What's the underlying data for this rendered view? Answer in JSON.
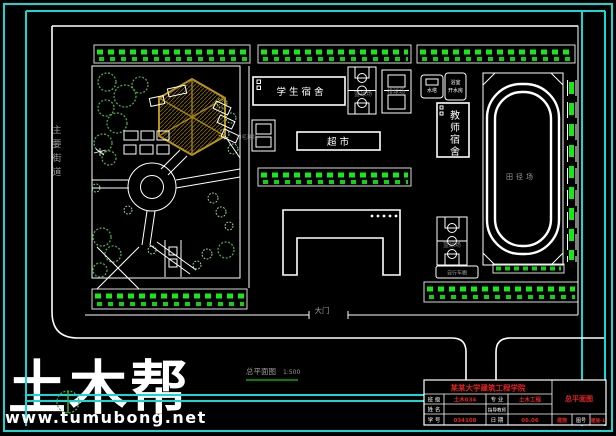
{
  "colors": {
    "background": "#000000",
    "frame_cyan": "#12d8d8",
    "drawing_white": "#ffffff",
    "hedge_green": "#17e817",
    "tree_green": "#4aa84a",
    "pavilion_olive": "#b8921a",
    "label_gray": "#9b9b9b",
    "title_block_red": "#e32222",
    "watermark_brand": "#4c3f24",
    "watermark_url": "#a9a9a9",
    "caption_underline": "#00aa00"
  },
  "watermark": {
    "brand": "土木帮",
    "url": "www.tumubong.net"
  },
  "street": {
    "main_street_chars": [
      "主",
      "要",
      "街",
      "道"
    ],
    "gate_label": "大门"
  },
  "caption": {
    "title": "总平面图",
    "scale": "1:500"
  },
  "buildings": {
    "student_dorm": "学 生 宿 舍",
    "supermarket": "超 市",
    "teacher_dorm_chars": [
      "教",
      "师",
      "宿",
      "舍"
    ],
    "water_tower": "水塔",
    "bathhouse": "浴室",
    "boiler_room": "开水房",
    "bike_shed": "自行车棚"
  },
  "sports": {
    "basketball": "篮球场",
    "volleyball": "排球场",
    "badminton": "羽毛球场",
    "track_field": "田径场"
  },
  "title_block": {
    "project": "某某大学建筑工程学院",
    "drawing_name": "总平面图",
    "class_label": "班 级",
    "class_value": "土木034",
    "major_label": "专 业",
    "major_value": "土木工程",
    "name_label": "姓 名",
    "advisor_label": "指导教师",
    "id_label": "学 号",
    "id_value": "034108",
    "date_label": "日 期",
    "date_value": "06.06",
    "sheet_type_value": "建施",
    "sheet_no_label": "图号",
    "sheet_no_value": "建施-1"
  }
}
